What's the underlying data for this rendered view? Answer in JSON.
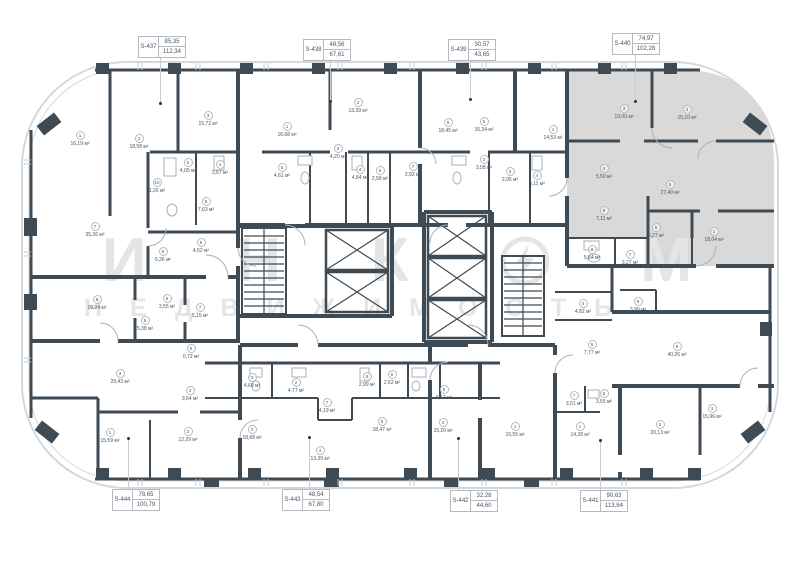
{
  "colors": {
    "wall": "#3E4A54",
    "outline": "#D5D8DB",
    "highlight": "#D9D9D9",
    "watermark": "#E5E5E5",
    "leader": "#C9CDD0",
    "label_text": "#4A5560",
    "label_border": "#B4BAC0"
  },
  "watermark": {
    "letters": [
      "И",
      "Н",
      "К"
    ],
    "tail": "М",
    "logo": "incom-circle-arrow-logo",
    "subtitle": "НЕДВИЖИМОСТЬ"
  },
  "units": [
    {
      "id": "S-437",
      "area_upper": "85,35",
      "area_lower": "112,34",
      "side": "top",
      "x": 138,
      "y": 36,
      "leader_x": 160,
      "leader_to": 103
    },
    {
      "id": "S-438",
      "area_upper": "48,56",
      "area_lower": "67,61",
      "side": "top",
      "x": 303,
      "y": 39,
      "leader_x": 330,
      "leader_to": 101
    },
    {
      "id": "S-439",
      "area_upper": "30,57",
      "area_lower": "43,65",
      "side": "top",
      "x": 448,
      "y": 39,
      "leader_x": 470,
      "leader_to": 99
    },
    {
      "id": "S-440",
      "area_upper": "74,97",
      "area_lower": "102,28",
      "side": "top",
      "x": 612,
      "y": 33,
      "leader_x": 635,
      "leader_to": 101
    },
    {
      "id": "S-444",
      "area_upper": "78,65",
      "area_lower": "100,79",
      "side": "bottom",
      "x": 112,
      "y": 489,
      "leader_x": 128,
      "leader_to": 438
    },
    {
      "id": "S-443",
      "area_upper": "48,54",
      "area_lower": "67,80",
      "side": "bottom",
      "x": 282,
      "y": 489,
      "leader_x": 309,
      "leader_to": 437
    },
    {
      "id": "S-442",
      "area_upper": "32,28",
      "area_lower": "44,60",
      "side": "bottom",
      "x": 450,
      "y": 490,
      "leader_x": 458,
      "leader_to": 438
    },
    {
      "id": "S-441",
      "area_upper": "90,63",
      "area_lower": "113,84",
      "side": "bottom",
      "x": 580,
      "y": 490,
      "leader_x": 600,
      "leader_to": 440
    }
  ],
  "rooms": [
    {
      "n": "1",
      "a": "16,19 м²",
      "x": 80,
      "y": 137
    },
    {
      "n": "2",
      "a": "18,58 м²",
      "x": 139,
      "y": 140
    },
    {
      "n": "3",
      "a": "15,72 м²",
      "x": 208,
      "y": 117
    },
    {
      "n": "5",
      "a": "4,05 м²",
      "x": 188,
      "y": 164
    },
    {
      "n": "4",
      "a": "3,67 м²",
      "x": 220,
      "y": 166
    },
    {
      "n": "10",
      "a": "1,26 м²",
      "x": 157,
      "y": 184
    },
    {
      "n": "8",
      "a": "7,63 м²",
      "x": 206,
      "y": 203
    },
    {
      "n": "7",
      "a": "35,26 м²",
      "x": 95,
      "y": 228
    },
    {
      "n": "6",
      "a": "5,36 м²",
      "x": 163,
      "y": 253
    },
    {
      "n": "9",
      "a": "4,52 м²",
      "x": 201,
      "y": 244
    },
    {
      "n": "8",
      "a": "19,24 м²",
      "x": 97,
      "y": 301
    },
    {
      "n": "5",
      "a": "5,38 м²",
      "x": 145,
      "y": 322
    },
    {
      "n": "6",
      "a": "3,55 м²",
      "x": 167,
      "y": 300
    },
    {
      "n": "7",
      "a": "5,15 м²",
      "x": 200,
      "y": 309
    },
    {
      "n": "9",
      "a": "0,72 м²",
      "x": 191,
      "y": 350
    },
    {
      "n": "3",
      "a": "29,43 м²",
      "x": 120,
      "y": 375
    },
    {
      "n": "4",
      "a": "3,64 м²",
      "x": 190,
      "y": 392
    },
    {
      "n": "1",
      "a": "15,59 м²",
      "x": 110,
      "y": 434
    },
    {
      "n": "2",
      "a": "12,29 м²",
      "x": 188,
      "y": 433
    },
    {
      "n": "1",
      "a": "16,68 м²",
      "x": 287,
      "y": 128
    },
    {
      "n": "2",
      "a": "13,39 м²",
      "x": 358,
      "y": 104
    },
    {
      "n": "3",
      "a": "4,20 м²",
      "x": 338,
      "y": 150
    },
    {
      "n": "5",
      "a": "4,61 м²",
      "x": 282,
      "y": 169
    },
    {
      "n": "4",
      "a": "4,84 м²",
      "x": 360,
      "y": 171
    },
    {
      "n": "6",
      "a": "2,58 м²",
      "x": 380,
      "y": 172
    },
    {
      "n": "8",
      "a": "18,45 м²",
      "x": 448,
      "y": 124
    },
    {
      "n": "7",
      "a": "2,92 м²",
      "x": 413,
      "y": 168
    },
    {
      "n": "5",
      "a": "16,34 м²",
      "x": 484,
      "y": 123
    },
    {
      "n": "1",
      "a": "14,53 м²",
      "x": 553,
      "y": 131
    },
    {
      "n": "2",
      "a": "3,58 м²",
      "x": 484,
      "y": 161
    },
    {
      "n": "3",
      "a": "2,05 м²",
      "x": 510,
      "y": 173
    },
    {
      "n": "4",
      "a": "5,11 м²",
      "x": 537,
      "y": 177
    },
    {
      "n": "3",
      "a": "13,00 м²",
      "x": 624,
      "y": 110
    },
    {
      "n": "2",
      "a": "15,10 м²",
      "x": 687,
      "y": 111
    },
    {
      "n": "5",
      "a": "27,40 м²",
      "x": 670,
      "y": 186
    },
    {
      "n": "4",
      "a": "5,50 м²",
      "x": 604,
      "y": 170
    },
    {
      "n": "9",
      "a": "7,11 м²",
      "x": 604,
      "y": 212
    },
    {
      "n": "6",
      "a": "5,27 м²",
      "x": 656,
      "y": 229
    },
    {
      "n": "1",
      "a": "18,04 м²",
      "x": 714,
      "y": 233
    },
    {
      "n": "8",
      "a": "5,64 м²",
      "x": 592,
      "y": 251
    },
    {
      "n": "7",
      "a": "3,27 м²",
      "x": 630,
      "y": 256
    },
    {
      "n": "4",
      "a": "4,82 м²",
      "x": 583,
      "y": 305
    },
    {
      "n": "9",
      "a": "3,99 м²",
      "x": 638,
      "y": 303
    },
    {
      "n": "5",
      "a": "7,77 м²",
      "x": 592,
      "y": 346
    },
    {
      "n": "8",
      "a": "40,26 м²",
      "x": 677,
      "y": 348
    },
    {
      "n": "7",
      "a": "3,51 м²",
      "x": 574,
      "y": 397
    },
    {
      "n": "6",
      "a": "3,55 м²",
      "x": 604,
      "y": 395
    },
    {
      "n": "1",
      "a": "14,28 м²",
      "x": 580,
      "y": 428
    },
    {
      "n": "2",
      "a": "20,13 м²",
      "x": 660,
      "y": 426
    },
    {
      "n": "3",
      "a": "15,96 м²",
      "x": 712,
      "y": 410
    },
    {
      "n": "1",
      "a": "4,60 м²",
      "x": 252,
      "y": 379
    },
    {
      "n": "2",
      "a": "4,77 м²",
      "x": 296,
      "y": 384
    },
    {
      "n": "5",
      "a": "2,99 м²",
      "x": 367,
      "y": 378
    },
    {
      "n": "6",
      "a": "2,62 м²",
      "x": 392,
      "y": 376
    },
    {
      "n": "7",
      "a": "4,19 м²",
      "x": 327,
      "y": 404
    },
    {
      "n": "3",
      "a": "18,68 м²",
      "x": 252,
      "y": 431
    },
    {
      "n": "4",
      "a": "13,39 м²",
      "x": 320,
      "y": 452
    },
    {
      "n": "8",
      "a": "18,47 м²",
      "x": 382,
      "y": 423
    },
    {
      "n": "2",
      "a": "15,20 м²",
      "x": 443,
      "y": 424
    },
    {
      "n": "5",
      "a": "6,17 м²",
      "x": 444,
      "y": 391
    },
    {
      "n": "1",
      "a": "16,55 м²",
      "x": 515,
      "y": 428
    }
  ]
}
